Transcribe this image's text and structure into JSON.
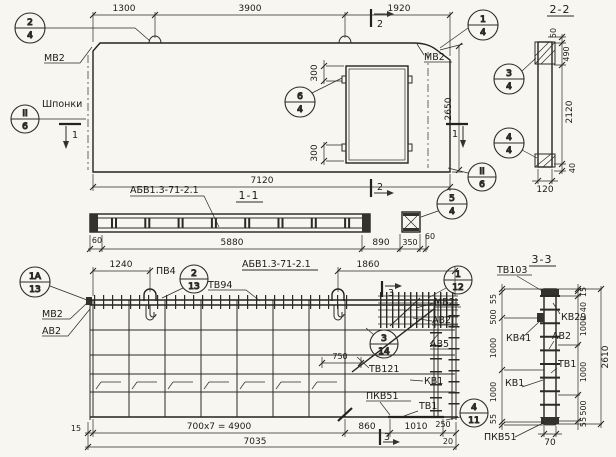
{
  "top_plan": {
    "dims": {
      "a": "1300",
      "b": "3900",
      "c": "1920",
      "total": "7120",
      "height": "2650",
      "open_top": "300",
      "open_bot": "300"
    },
    "labels": {
      "mv2_left": "МВ2",
      "mv2_right": "МВ2",
      "shponki": "Шпонки"
    },
    "callouts": {
      "c24": {
        "t": "2",
        "b": "4"
      },
      "c14": {
        "t": "1",
        "b": "4"
      },
      "c64": {
        "t": "6",
        "b": "4"
      },
      "cii6l": {
        "t": "II",
        "b": "6"
      },
      "cii6r": {
        "t": "II",
        "b": "6"
      }
    },
    "marks": {
      "s1": "1",
      "s2": "2"
    }
  },
  "section_2_2": {
    "title": "2-2",
    "dims": {
      "d50": "50",
      "d490": "490",
      "d2120": "2120",
      "d40": "40",
      "d120": "120"
    },
    "callouts": {
      "c34": {
        "t": "3",
        "b": "4"
      },
      "c44": {
        "t": "4",
        "b": "4"
      }
    }
  },
  "section_1_1": {
    "title": "1-1",
    "label": "АБВ1.3-71-2.1",
    "dims": {
      "d60l": "60",
      "d5880": "5880",
      "d890": "890",
      "d350": "350",
      "d60r": "60"
    },
    "callouts": {
      "c54": {
        "t": "5",
        "b": "4"
      }
    }
  },
  "bottom_plan": {
    "title": "АБВ1.3-71-2.1",
    "dims": {
      "d1240": "1240",
      "d1860": "1860",
      "d750": "750",
      "d15": "15",
      "d4900": "700x7 = 4900",
      "d7035": "7035",
      "d860": "860",
      "d1010": "1010",
      "d250": "250",
      "d20": "20"
    },
    "labels": {
      "pv4": "ПВ4",
      "tv94": "ТВ94",
      "mv2l": "МВ2",
      "av2l": "АВ2",
      "mv2r": "МВ2",
      "av2r": "АВ2",
      "av5": "АВ5",
      "tv121": "ТВ121",
      "kv1": "КВ1",
      "pkv51": "ПКВ51",
      "tv1": "ТВ1"
    },
    "callouts": {
      "c1a13": {
        "t": "1А",
        "b": "13"
      },
      "c213": {
        "t": "2",
        "b": "13"
      },
      "c112": {
        "t": "1",
        "b": "12"
      },
      "c314": {
        "t": "3",
        "b": "14"
      },
      "c411": {
        "t": "4",
        "b": "11"
      }
    },
    "marks": {
      "s3": "3"
    }
  },
  "section_3_3": {
    "title": "3-3",
    "labels": {
      "tv103": "ТВ103",
      "kv29": "КВ29",
      "kv41": "КВ41",
      "av2": "АВ2",
      "tv1": "ТВ1",
      "kv1": "КВ1",
      "pkv51": "ПКВ51"
    },
    "left_chain": [
      "55",
      "500",
      "1000",
      "1000",
      "55"
    ],
    "right_chain": [
      "15",
      "40",
      "1000",
      "1000",
      "500",
      "55"
    ],
    "dims": {
      "total": "2610",
      "width": "70"
    }
  }
}
